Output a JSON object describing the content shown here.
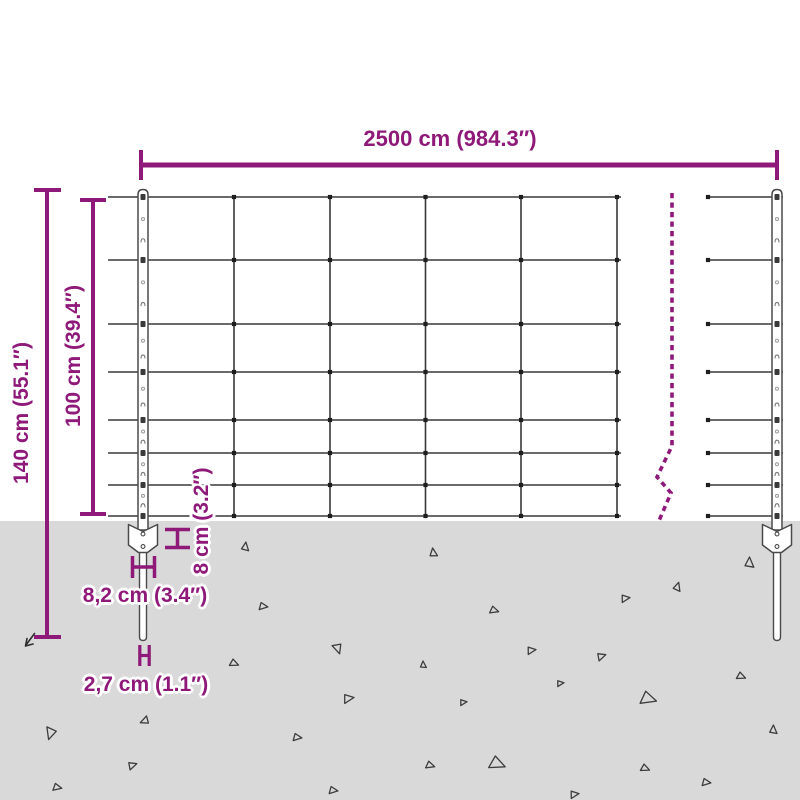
{
  "diagram_type": "product-dimension-diagram",
  "subject": "wire mesh fence with two posts, ground anchor plates and spikes",
  "labels": {
    "total_width": "2500 cm (984.3″)",
    "total_height": "140 cm (55.1″)",
    "mesh_height": "100 cm (39.4″)",
    "anchor_depth": "8 cm (3.2″)",
    "anchor_plate_width": "8,2 cm (3.4″)",
    "spike_width": "2,7 cm (1.1″)"
  },
  "colors": {
    "dimension": "#8e1979",
    "wire": "#383838",
    "dot": "#1e1e1e",
    "ground": "#d9d9d9",
    "post": "#4a4a4a",
    "triangle": "#3d3d3d",
    "background": "#ffffff"
  },
  "geometry": {
    "canvas": {
      "w": 800,
      "h": 800
    },
    "ground_y": 521,
    "wire_rows_y": [
      197,
      260,
      324,
      372,
      420,
      453,
      485,
      516
    ],
    "mesh_sections": [
      {
        "x1": 108,
        "x2": 621,
        "verticals": [
          234,
          330,
          425.5,
          521,
          617
        ],
        "end_dots_x": []
      },
      {
        "x1": 706,
        "x2": 783,
        "verticals": [],
        "end_dots_x": [
          708
        ]
      }
    ],
    "posts_x": [
      143,
      777
    ],
    "post": {
      "top_y": 189.5,
      "plate_top": 524.5,
      "plate_bottom": 552.5,
      "plate_half_w": 14.5,
      "spike_bottom": 640.5,
      "spike_half_w": 3.5
    },
    "break_line": [
      [
        672,
        193
      ],
      [
        672,
        446
      ],
      [
        657,
        477
      ],
      [
        671,
        493
      ],
      [
        658,
        523
      ]
    ],
    "dims": {
      "top": {
        "y": 165,
        "x1": 141,
        "x2": 777,
        "tick_y1": 150,
        "tick_y2": 180
      },
      "h140": {
        "x": 47,
        "y1": 189,
        "y2": 638,
        "tick_x1": 34,
        "tick_x2": 61
      },
      "h100": {
        "x": 93,
        "y1": 199,
        "y2": 515,
        "tick_x1": 80,
        "tick_x2": 106
      },
      "v8": {
        "x": 177.5,
        "y1": 529,
        "y2": 548,
        "tick_x1": 165,
        "tick_x2": 190
      },
      "h82": {
        "y": 567,
        "x1": 132,
        "x2": 155,
        "tick_y1": 556,
        "tick_y2": 578
      },
      "h27": {
        "y": 655.5,
        "x1": 139.5,
        "x2": 149.5,
        "tick_y1": 645,
        "tick_y2": 666
      }
    },
    "stray_arrow": {
      "d": "M34.5,633.5 L26,645 M25.5,646 L33,644 M25.5,646 L27,638.5"
    },
    "triangles": [
      [
        245,
        547,
        5,
        10
      ],
      [
        433,
        553,
        5,
        355
      ],
      [
        749,
        563,
        6,
        5
      ],
      [
        263,
        606,
        5,
        100
      ],
      [
        677,
        587,
        5,
        20
      ],
      [
        625,
        598,
        5,
        85
      ],
      [
        494,
        610,
        5,
        110
      ],
      [
        338,
        648,
        6,
        165
      ],
      [
        234,
        663,
        5,
        115
      ],
      [
        531,
        650,
        5,
        85
      ],
      [
        601,
        656,
        5,
        75
      ],
      [
        741,
        676,
        5,
        115
      ],
      [
        348,
        698,
        6,
        85
      ],
      [
        648,
        698,
        9,
        110
      ],
      [
        145,
        721,
        5,
        250
      ],
      [
        51,
        733,
        7,
        200
      ],
      [
        297,
        737,
        5,
        100
      ],
      [
        423,
        665,
        4,
        0
      ],
      [
        463,
        702,
        4,
        85
      ],
      [
        560,
        683,
        4,
        85
      ],
      [
        430,
        765,
        5,
        110
      ],
      [
        497,
        763,
        9,
        115
      ],
      [
        574,
        794,
        5,
        85
      ],
      [
        645,
        768,
        5,
        115
      ],
      [
        706,
        782,
        5,
        100
      ],
      [
        773,
        730,
        5,
        5
      ],
      [
        132,
        765,
        5,
        75
      ],
      [
        57,
        787,
        5,
        105
      ],
      [
        333,
        790,
        5,
        100
      ]
    ]
  }
}
